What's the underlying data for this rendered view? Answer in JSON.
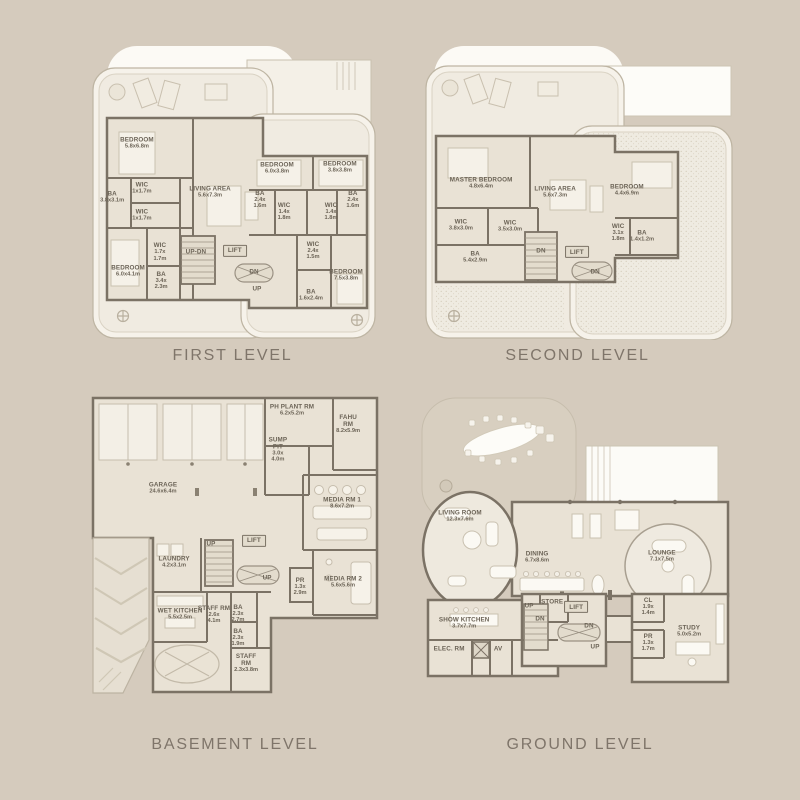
{
  "page": {
    "background": "#d5cbbd"
  },
  "colors": {
    "wall": "#7b7265",
    "floor": "#e9e2d5",
    "tower": "#f6f2ea",
    "white": "#fcfaf5",
    "label": "#6b6356",
    "caption": "#7f756a"
  },
  "levels": {
    "first": {
      "caption": "FIRST LEVEL",
      "rooms": [
        {
          "name": "BEDROOM",
          "dims": "5.8x6.8m",
          "x": 17.6,
          "y": 34.3
        },
        {
          "name": "WIC",
          "dims": "1x1.7m",
          "x": 19.3,
          "y": 49.3
        },
        {
          "name": "BA",
          "dims": "3.8x3.1m",
          "x": 9.2,
          "y": 52.3
        },
        {
          "name": "WIC",
          "dims": "1x1.7m",
          "x": 19.3,
          "y": 58.3
        },
        {
          "name": "LIVING AREA",
          "dims": "5.6x7.3m",
          "x": 42.4,
          "y": 50.7
        },
        {
          "name": "BEDROOM",
          "dims": "6.0x3.8m",
          "x": 65.1,
          "y": 42.7
        },
        {
          "name": "BEDROOM",
          "dims": "3.8x3.8m",
          "x": 86.4,
          "y": 42.3
        },
        {
          "name": "BA",
          "dims": "2.4x\n1.6m",
          "x": 59.3,
          "y": 53.3
        },
        {
          "name": "WIC",
          "dims": "1.4x\n1.8m",
          "x": 67.5,
          "y": 57.3
        },
        {
          "name": "WIC",
          "dims": "1.4x\n1.8m",
          "x": 83.4,
          "y": 57.3
        },
        {
          "name": "BA",
          "dims": "2.4x\n1.6m",
          "x": 90.8,
          "y": 53.3
        },
        {
          "name": "BEDROOM",
          "dims": "6.0x4.1m",
          "x": 14.6,
          "y": 77.0
        },
        {
          "name": "WIC",
          "dims": "1.7x\n1.7m",
          "x": 25.4,
          "y": 70.7
        },
        {
          "name": "BA",
          "dims": "3.4x\n2.3m",
          "x": 25.8,
          "y": 80.3
        },
        {
          "name": "UP-DN",
          "dims": "",
          "x": 37.6,
          "y": 70.7
        },
        {
          "name": "LIFT",
          "dims": "",
          "x": 50.8,
          "y": 70.3,
          "boxed": true
        },
        {
          "name": "DN",
          "dims": "",
          "x": 57.3,
          "y": 77.3
        },
        {
          "name": "UP",
          "dims": "",
          "x": 58.3,
          "y": 83.0
        },
        {
          "name": "WIC",
          "dims": "2.4x\n1.5m",
          "x": 77.3,
          "y": 70.3
        },
        {
          "name": "BA",
          "dims": "1.6x2.4m",
          "x": 76.6,
          "y": 85.0
        },
        {
          "name": "BEDROOM",
          "dims": "7.5x3.8m",
          "x": 88.5,
          "y": 78.3
        }
      ]
    },
    "second": {
      "caption": "SECOND LEVEL",
      "rooms": [
        {
          "name": "MASTER BEDROOM",
          "dims": "4.8x6.4m",
          "x": 19.4,
          "y": 47.7
        },
        {
          "name": "LIVING AREA",
          "dims": "5.6x7.3m",
          "x": 42.9,
          "y": 50.7
        },
        {
          "name": "BEDROOM",
          "dims": "4.4x6.9m",
          "x": 65.7,
          "y": 50.0
        },
        {
          "name": "WIC",
          "dims": "3.8x3.0m",
          "x": 13.0,
          "y": 61.7
        },
        {
          "name": "WIC",
          "dims": "3.5x3.0m",
          "x": 28.6,
          "y": 62.0
        },
        {
          "name": "BA",
          "dims": "5.4x2.9m",
          "x": 17.5,
          "y": 72.3
        },
        {
          "name": "DN",
          "dims": "",
          "x": 38.4,
          "y": 70.3
        },
        {
          "name": "LIFT",
          "dims": "",
          "x": 49.8,
          "y": 70.7,
          "boxed": true
        },
        {
          "name": "DN",
          "dims": "",
          "x": 55.6,
          "y": 77.3
        },
        {
          "name": "WIC",
          "dims": "3.1x\n1.8m",
          "x": 62.9,
          "y": 64.3
        },
        {
          "name": "BA",
          "dims": "1.4x1.2m",
          "x": 70.5,
          "y": 65.3
        }
      ]
    },
    "basement": {
      "caption": "BASEMENT LEVEL",
      "rooms": [
        {
          "name": "PH PLANT RM",
          "dims": "6.2x5.2m",
          "x": 69.0,
          "y": 6.3
        },
        {
          "name": "FAHU\nRM",
          "dims": "8.2x5.9m",
          "x": 87.7,
          "y": 10.8
        },
        {
          "name": "SUMP\nPIT",
          "dims": "3.0x\n4.0m",
          "x": 64.3,
          "y": 19.0
        },
        {
          "name": "GARAGE",
          "dims": "24.6x6.4m",
          "x": 26.0,
          "y": 31.1
        },
        {
          "name": "MEDIA RM 1",
          "dims": "8.6x7.2m",
          "x": 85.7,
          "y": 35.9
        },
        {
          "name": "UP",
          "dims": "",
          "x": 42.0,
          "y": 48.9
        },
        {
          "name": "LIFT",
          "dims": "",
          "x": 56.3,
          "y": 47.9,
          "boxed": true
        },
        {
          "name": "LAUNDRY",
          "dims": "4.2x3.1m",
          "x": 29.7,
          "y": 54.6
        },
        {
          "name": "UP",
          "dims": "",
          "x": 60.7,
          "y": 59.7
        },
        {
          "name": "PR",
          "dims": "1.3x\n2.9m",
          "x": 71.7,
          "y": 62.5
        },
        {
          "name": "MEDIA RM 2",
          "dims": "5.6x5.6m",
          "x": 86.0,
          "y": 61.0
        },
        {
          "name": "WET KITCHEN",
          "dims": "5.5x2.5m",
          "x": 31.7,
          "y": 71.1
        },
        {
          "name": "STAFF RM",
          "dims": "2.6x\n4.1m",
          "x": 43.0,
          "y": 71.4
        },
        {
          "name": "BA",
          "dims": "2.3x\n2.7m",
          "x": 51.0,
          "y": 71.1
        },
        {
          "name": "BA",
          "dims": "2.3x\n1.9m",
          "x": 51.0,
          "y": 78.7
        },
        {
          "name": "STAFF\nRM",
          "dims": "2.3x3.8m",
          "x": 53.7,
          "y": 86.7
        }
      ]
    },
    "ground": {
      "caption": "GROUND LEVEL",
      "rooms": [
        {
          "name": "LIVING ROOM",
          "dims": "12.3x7.6m",
          "x": 12.5,
          "y": 40.0
        },
        {
          "name": "DINING",
          "dims": "6.7x8.6m",
          "x": 36.6,
          "y": 53.0
        },
        {
          "name": "LOUNGE",
          "dims": "7.1x7.5m",
          "x": 75.6,
          "y": 52.7
        },
        {
          "name": "SHOW KITCHEN",
          "dims": "3.7x7.7m",
          "x": 13.8,
          "y": 74.0
        },
        {
          "name": "ELEC. RM",
          "dims": "",
          "x": 9.1,
          "y": 82.2
        },
        {
          "name": "AV",
          "dims": "",
          "x": 24.4,
          "y": 82.2
        },
        {
          "name": "UP",
          "dims": "",
          "x": 34.1,
          "y": 68.6
        },
        {
          "name": "STORE",
          "dims": "",
          "x": 41.3,
          "y": 67.3
        },
        {
          "name": "LIFT",
          "dims": "",
          "x": 48.8,
          "y": 68.9,
          "boxed": true
        },
        {
          "name": "DN",
          "dims": "",
          "x": 37.5,
          "y": 72.7
        },
        {
          "name": "DN",
          "dims": "",
          "x": 52.8,
          "y": 74.9
        },
        {
          "name": "UP",
          "dims": "",
          "x": 54.7,
          "y": 81.6
        },
        {
          "name": "CL",
          "dims": "1.9x\n1.4m",
          "x": 71.3,
          "y": 68.9
        },
        {
          "name": "PR",
          "dims": "1.3x\n1.7m",
          "x": 71.3,
          "y": 80.3
        },
        {
          "name": "STUDY",
          "dims": "5.0x5.2m",
          "x": 84.1,
          "y": 76.5
        }
      ]
    }
  }
}
